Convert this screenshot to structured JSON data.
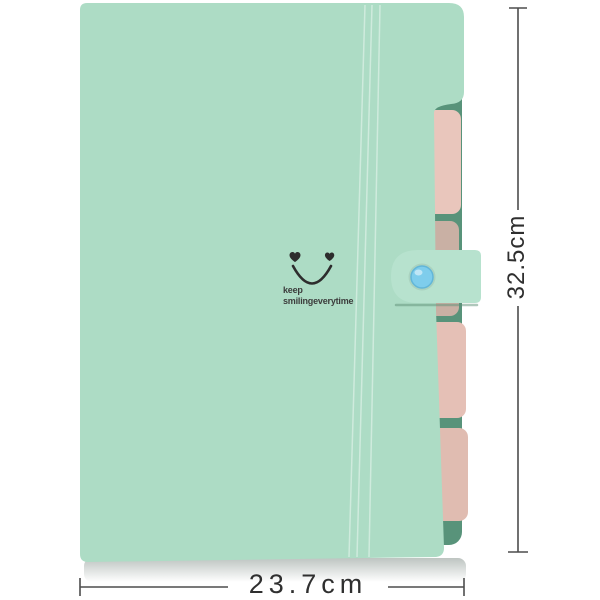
{
  "folder": {
    "cover_text_line1": "keep",
    "cover_text_line2": "smilingeverytime",
    "smiley_icon": "heart-eyes-smiley",
    "snap_button_icon": "round-snap-button"
  },
  "dimensions": {
    "width_label": "23.7cm",
    "height_label": "32.5cm"
  },
  "colors": {
    "cover_mint": "#addcc5",
    "strap_mint": "#b7e2ce",
    "back_teal": "#58937a",
    "tab_pink": "#e9c6bc",
    "tab_tan": "#c9b0a4",
    "tab_pink_light": "#e5c0b6",
    "tab_pink_dark": "#e0bcb1",
    "button_blue": "#7ecdec",
    "ink": "#2d2d2d",
    "dimension_line": "#4d4d4d"
  }
}
